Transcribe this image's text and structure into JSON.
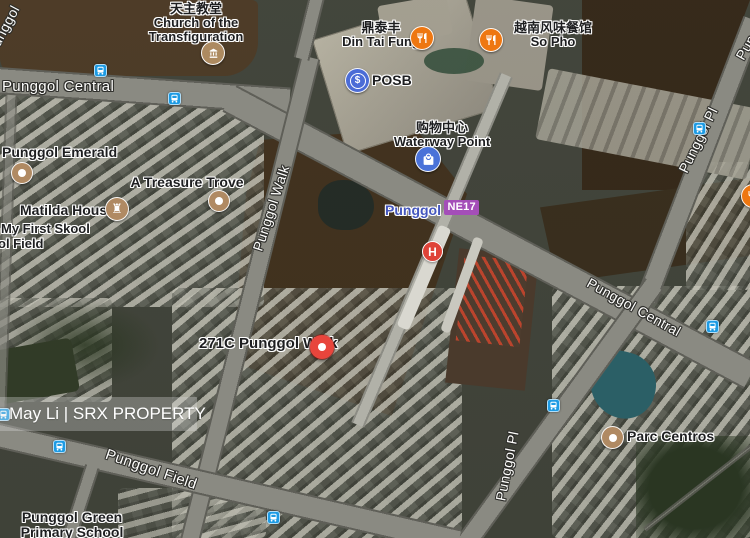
{
  "colors": {
    "marker-red": "#e8453c",
    "h-red": "#df4338",
    "bus-blue": "#1d9be4",
    "poi-tan": "#b08a63",
    "restaurant-orange": "#ee7711",
    "posb-blue": "#4b6cd6",
    "mall-blue": "#4a72d8",
    "ne-line-purple": "#a44eb8",
    "station-text-blue": "#4456bd",
    "church-tan": "#ad8a60"
  },
  "watermark": {
    "text": "May Li | SRX PROPERTY"
  },
  "station": {
    "name": "Punggol",
    "badge": "NE17"
  },
  "marker271c": {
    "label": "271C Punggol Walk"
  },
  "pois": {
    "church": {
      "line1": "天主教堂",
      "line2": "Church of the",
      "line3": "Transfiguration"
    },
    "punggolEmerald": {
      "label": "Punggol Emerald"
    },
    "treasureTrove": {
      "label": "A Treasure Trove"
    },
    "matildaHouse": {
      "label": "Matilda House"
    },
    "myFirstSkool": {
      "line1": "My First Skool",
      "line2": "ol Field"
    },
    "dinTaiFung": {
      "line1": "鼎泰丰",
      "line2": "Din Tai Fung"
    },
    "posb": {
      "label": "POSB"
    },
    "soPho": {
      "line1": "越南风味餐馆",
      "line2": "So Pho"
    },
    "waterwayPoint": {
      "line1": "购物中心",
      "line2": "Waterway Point"
    },
    "parcCentros": {
      "label": "Parc Centros"
    },
    "punggolGreen": {
      "line1": "Punggol Green",
      "line2": "Primary School"
    },
    "hospital": {
      "glyph": "H"
    }
  },
  "roads": {
    "punggolCentralTop": "Punggol Central",
    "punggolCentralRight": "Punggol Central",
    "punggolWalk": "Punggol Walk",
    "punggolPlTop": "Punggol Pl",
    "punggolPlBottom": "Punggol Pl",
    "punggolField": "Punggol Field",
    "cornerTopLeft": "Punggol",
    "cornerTopRight": "Punggol Pl"
  },
  "icons": {
    "posbDollar": "$",
    "rook": "♜"
  }
}
